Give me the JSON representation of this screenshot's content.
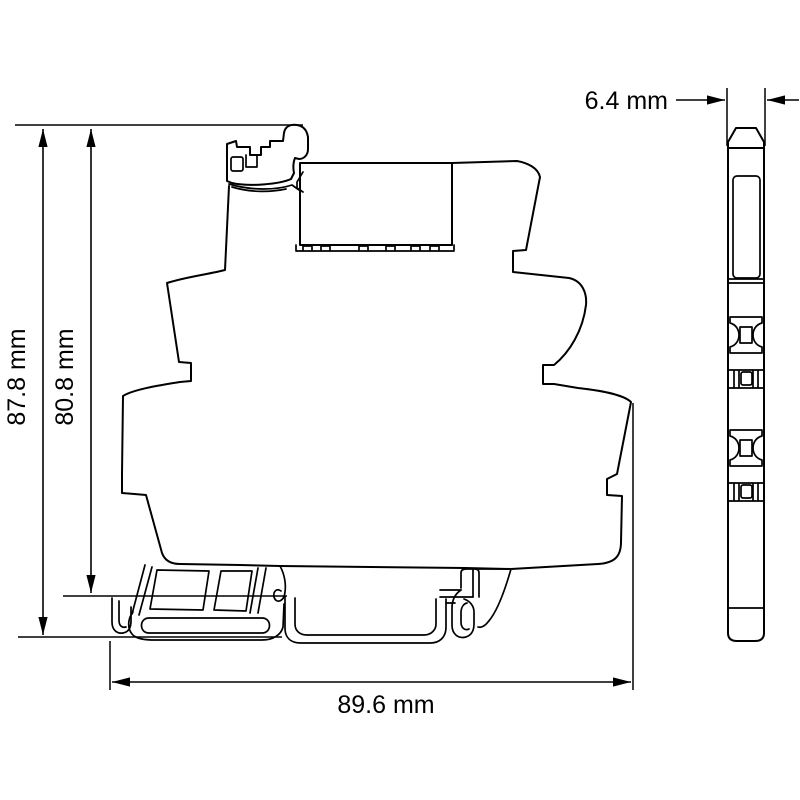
{
  "diagram": {
    "background": "#ffffff",
    "line_color": "#000000",
    "views": {
      "front": {
        "label": "front-profile-view"
      },
      "side": {
        "label": "side-width-view"
      }
    },
    "dimensions": {
      "overall_height": {
        "label": "87.8 mm",
        "value": 87.8,
        "unit": "mm",
        "orientation": "vertical"
      },
      "rail_height": {
        "label": "80.8 mm",
        "value": 80.8,
        "unit": "mm",
        "orientation": "vertical"
      },
      "depth": {
        "label": "89.6 mm",
        "value": 89.6,
        "unit": "mm",
        "orientation": "horizontal"
      },
      "width": {
        "label": "6.4 mm",
        "value": 6.4,
        "unit": "mm",
        "orientation": "horizontal"
      }
    }
  }
}
